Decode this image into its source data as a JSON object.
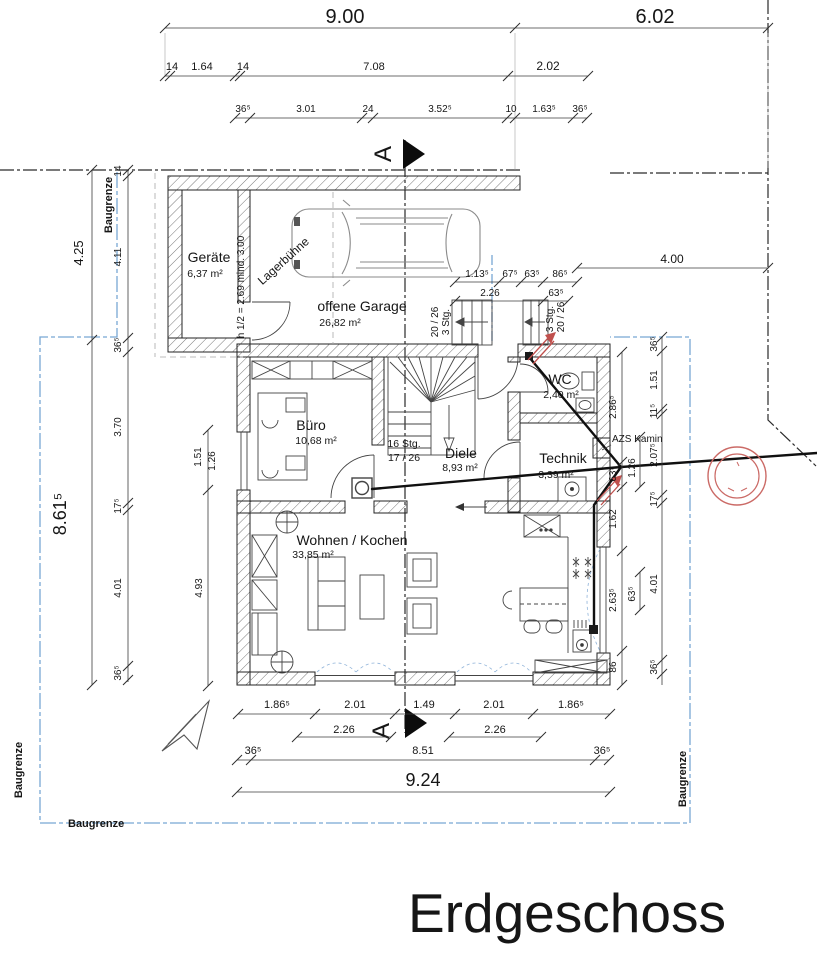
{
  "title": "Erdgeschoss",
  "baugrenze_label": "Baugrenze",
  "section_label": "A",
  "rooms": {
    "geraete": {
      "name": "Geräte",
      "area": "6,37 m²"
    },
    "garage": {
      "name": "offene Garage",
      "area": "26,82 m²"
    },
    "buero": {
      "name": "Büro",
      "area": "10,68 m²"
    },
    "diele": {
      "name": "Diele",
      "area": "8,93 m²"
    },
    "wc": {
      "name": "WC",
      "area": "2,40 m²"
    },
    "technik": {
      "name": "Technik",
      "area": "3,39 m²"
    },
    "wohnen": {
      "name": "Wohnen / Kochen",
      "area": "33,85 m²"
    }
  },
  "notes": {
    "lagerbuehne": "Lagerbühne",
    "height_note": "h 1/2 = 2.69 mind. 3.00",
    "stairs3_a": "20 / 26",
    "stairs3_b": "3 Stg.",
    "stairs16_a": "16 Stg.",
    "stairs16_b": "17 / 26",
    "kamin": "AZS Kamin"
  },
  "dims": {
    "top1": [
      "9.00",
      "6.02"
    ],
    "top2": [
      "14",
      "1.64",
      "14",
      "7.08",
      "2.02"
    ],
    "top3": [
      "36⁵",
      "3.01",
      "24",
      "3.52⁵",
      "10",
      "1.63⁵",
      "36⁵"
    ],
    "entry1": [
      "1.13⁵",
      "67⁵",
      "63⁵",
      "86⁵"
    ],
    "entry2": [
      "2.26",
      "63⁵"
    ],
    "right_top": "4.00",
    "left_outer": [
      "4.25",
      "8.61⁵"
    ],
    "left_inner": [
      "14",
      "4.11",
      "36⁵",
      "3.70",
      "17⁵",
      "4.01",
      "36⁵"
    ],
    "left_third": [
      "1.51",
      "1.26",
      "4.93"
    ],
    "right_col_inner": [
      "2.86⁵",
      "63⁵",
      "1.62",
      "2.63⁵",
      "86"
    ],
    "right_col_mid": [
      "1.26",
      "63⁵"
    ],
    "right_col_outer": [
      "36⁵",
      "1.51",
      "11⁵",
      "2.07⁵",
      "17⁵",
      "4.01",
      "36⁵"
    ],
    "bottom1": [
      "1.86⁵",
      "2.01",
      "1.49",
      "2.01",
      "1.86⁵"
    ],
    "bottom1b": [
      "2.26",
      "2.26"
    ],
    "bottom2": [
      "36⁵",
      "8.51",
      "36⁵"
    ],
    "bottom3": "9.24"
  },
  "colors": {
    "baugrenze_blue": "#78a7d4",
    "stamp_red": "#c0504d",
    "ink": "#161616"
  }
}
